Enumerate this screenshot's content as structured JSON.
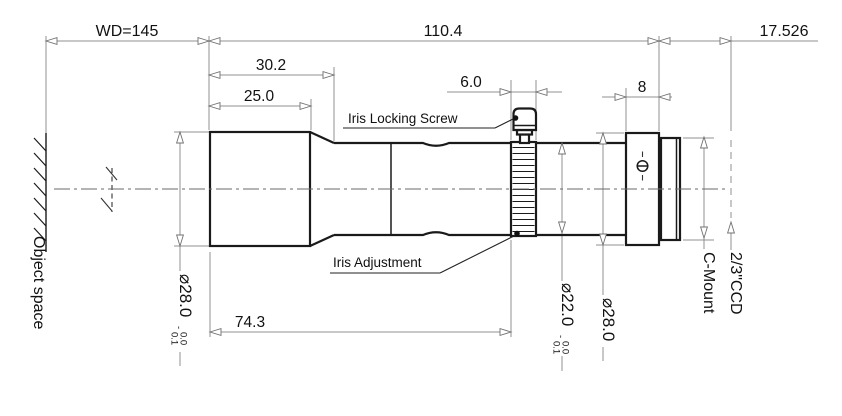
{
  "drawing": {
    "title": "lens-mechanical-drawing",
    "dims": {
      "wd": "WD=145",
      "total_length": "110.4",
      "flange_back": "17.526",
      "front_section": "30.2",
      "front_barrel": "25.0",
      "iris_ring_width": "6.0",
      "mount_ring_width": "8",
      "body_length": "74.3"
    },
    "labels": {
      "iris_locking_screw": "Iris Locking Screw",
      "iris_adjustment": "Iris Adjustment",
      "object_space": "Object space",
      "c_mount": "C-Mount",
      "ccd": "2/3\"CCD"
    },
    "diameters": {
      "front": {
        "value": "⌀28.0",
        "tol_sign": "-",
        "tol_upper": "0.0",
        "tol_lower": "0.1"
      },
      "iris": {
        "value": "⌀22.0",
        "tol_sign": "-",
        "tol_upper": "0.0",
        "tol_lower": "0.1"
      },
      "mount": {
        "value": "⌀28.0"
      }
    },
    "colors": {
      "outline": "#1a1a1a",
      "dimension_lines": "#909090",
      "text": "#111111",
      "background": "#ffffff"
    }
  }
}
